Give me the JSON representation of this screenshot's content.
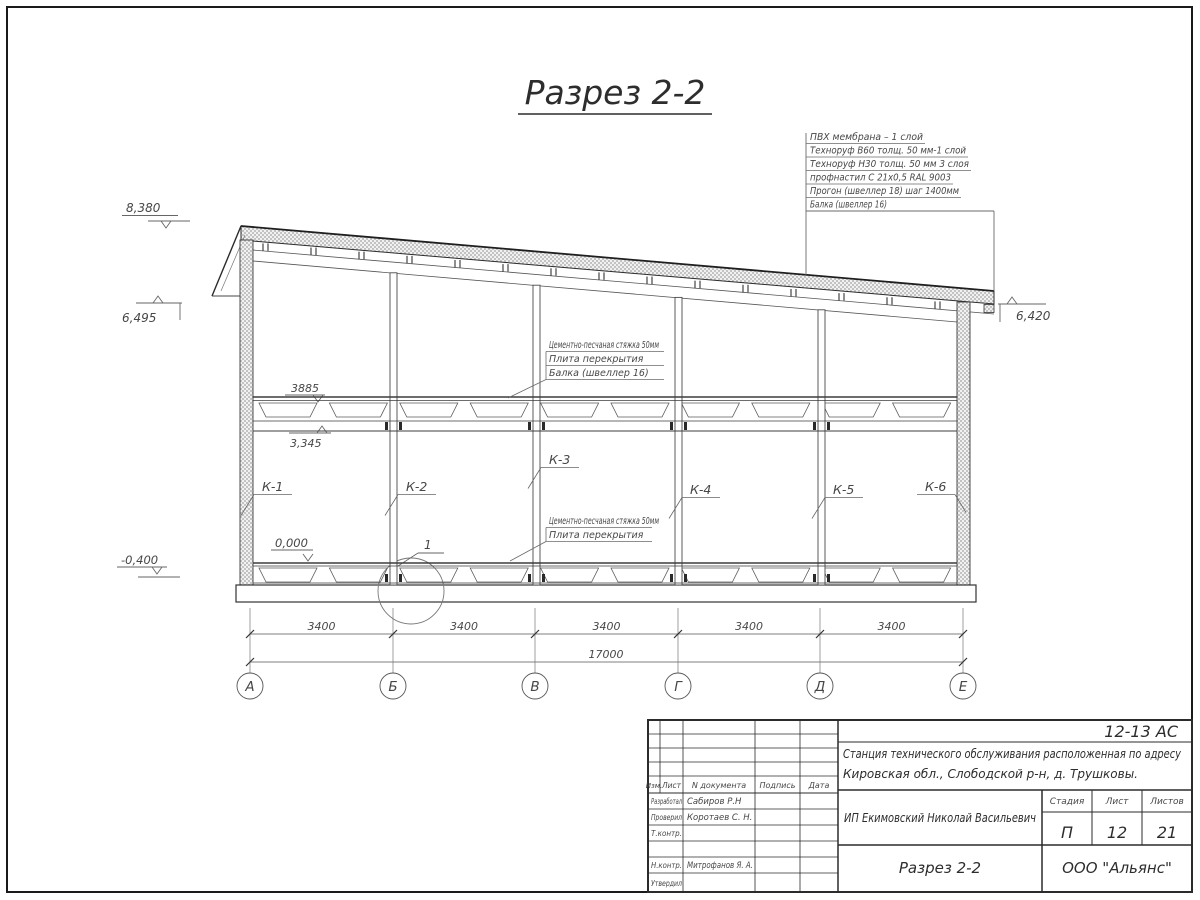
{
  "heading": "Разрез 2-2",
  "roof_layers": [
    "ПВХ мембрана – 1 слой",
    "Техноруф В60 толщ. 50 мм-1 слой",
    "Техноруф Н30 толщ. 50 мм 3 слоя",
    "профнастил С 21х0,5 RAL 9003",
    "Прогон (швеллер 18) шаг 1400мм",
    "Балка (швеллер 16)"
  ],
  "floor_note_upper": [
    "Цементно-песчаная стяжка 50мм",
    "Плита перекрытия",
    "Балка (швеллер 16)"
  ],
  "floor_note_lower": [
    "Цементно-песчаная стяжка 50мм",
    "Плита перекрытия"
  ],
  "elevations": {
    "ridge": "8,380",
    "eave_left": "6,495",
    "eave_right": "6,420",
    "slab_top_dim": "3885",
    "slab_bottom": "3,345",
    "floor": "0,000",
    "ground": "-0,400"
  },
  "columns": [
    "К-1",
    "К-2",
    "К-3",
    "К-4",
    "К-5",
    "К-6"
  ],
  "detail_mark": "1",
  "dimensions": {
    "bays": [
      "3400",
      "3400",
      "3400",
      "3400",
      "3400"
    ],
    "total": "17000"
  },
  "axes": [
    "А",
    "Б",
    "В",
    "Г",
    "Д",
    "Е"
  ],
  "sheet": {
    "doc_code": "12-13 АС",
    "project_name_line1": "Станция технического обслуживания расположенная по адресу",
    "project_name_line2": "Кировская обл., Слободской р-н, д. Трушковы.",
    "client": "ИП Екимовский Николай Васильевич",
    "drawing_name": "Разрез 2-2",
    "organization": "ООО \"Альянс\"",
    "stage_label": "Стадия",
    "stage": "П",
    "sheet_label": "Лист",
    "sheet_number": "12",
    "sheets_label": "Листов",
    "sheets_total": "21",
    "header_cols": [
      "Изм.",
      "Лист",
      "N документа",
      "Подпись",
      "Дата"
    ],
    "signature_rows": [
      {
        "role": "Разработал",
        "name": "Сабиров Р.Н"
      },
      {
        "role": "Проверил",
        "name": "Коротаев С. Н."
      },
      {
        "role": "Т.контр.",
        "name": ""
      },
      {
        "role": "",
        "name": ""
      },
      {
        "role": "Н.контр.",
        "name": "Митрофанов Я. А."
      },
      {
        "role": "Утвердил",
        "name": ""
      }
    ]
  }
}
